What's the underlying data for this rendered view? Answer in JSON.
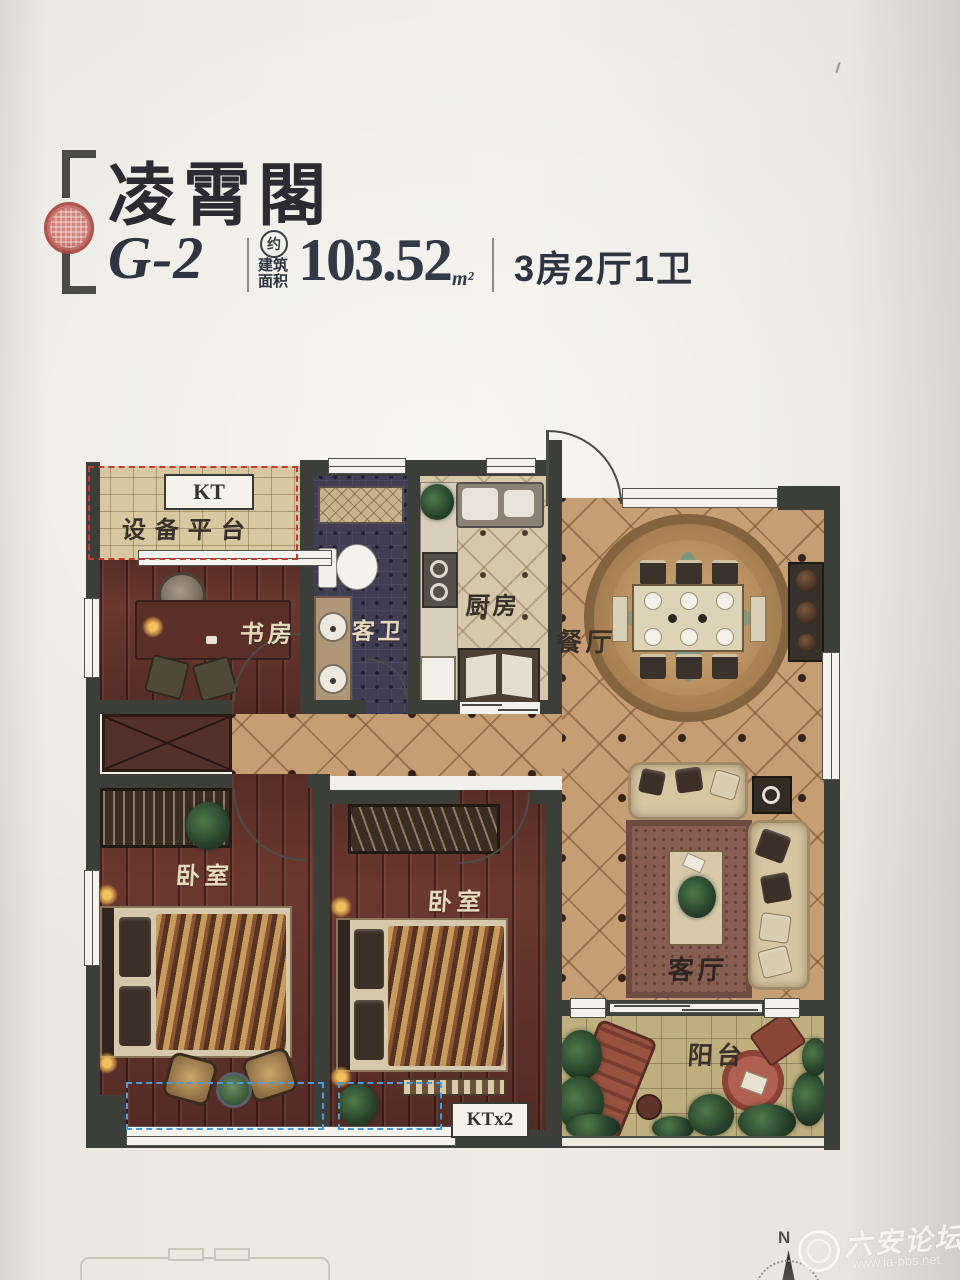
{
  "header": {
    "title": "凌霄閣",
    "unit": "G-2",
    "approx_badge": "约",
    "area_label_line1": "建筑",
    "area_label_line2": "面积",
    "area_value": "103.52",
    "area_unit": "m²",
    "layout_spec": "3房2厅1卫"
  },
  "floorplan": {
    "rooms": {
      "kt_badge": "KT",
      "equipment_platform": "设备平台",
      "study": "书房",
      "guest_bath": "客卫",
      "kitchen": "厨房",
      "dining": "餐厅",
      "bedroom_left": "卧室",
      "bedroom_middle": "卧室",
      "living": "客厅",
      "balcony": "阳台",
      "ktx2_badge": "KTx2"
    }
  },
  "compass": {
    "north_label": "N"
  },
  "watermark": {
    "site_name": "六安论坛",
    "site_url": "www.la-bbs.net"
  },
  "colors": {
    "wall": "#3b3e39",
    "wood_floor": "#6b382f",
    "tile_floor": "#c69e73",
    "bath_floor": "#403d55",
    "platform_dash_red": "#c23b30",
    "ac_platform_dash_blue": "#4a9be0",
    "seal_red": "#c06a63",
    "title_ink": "#2c2b31"
  }
}
